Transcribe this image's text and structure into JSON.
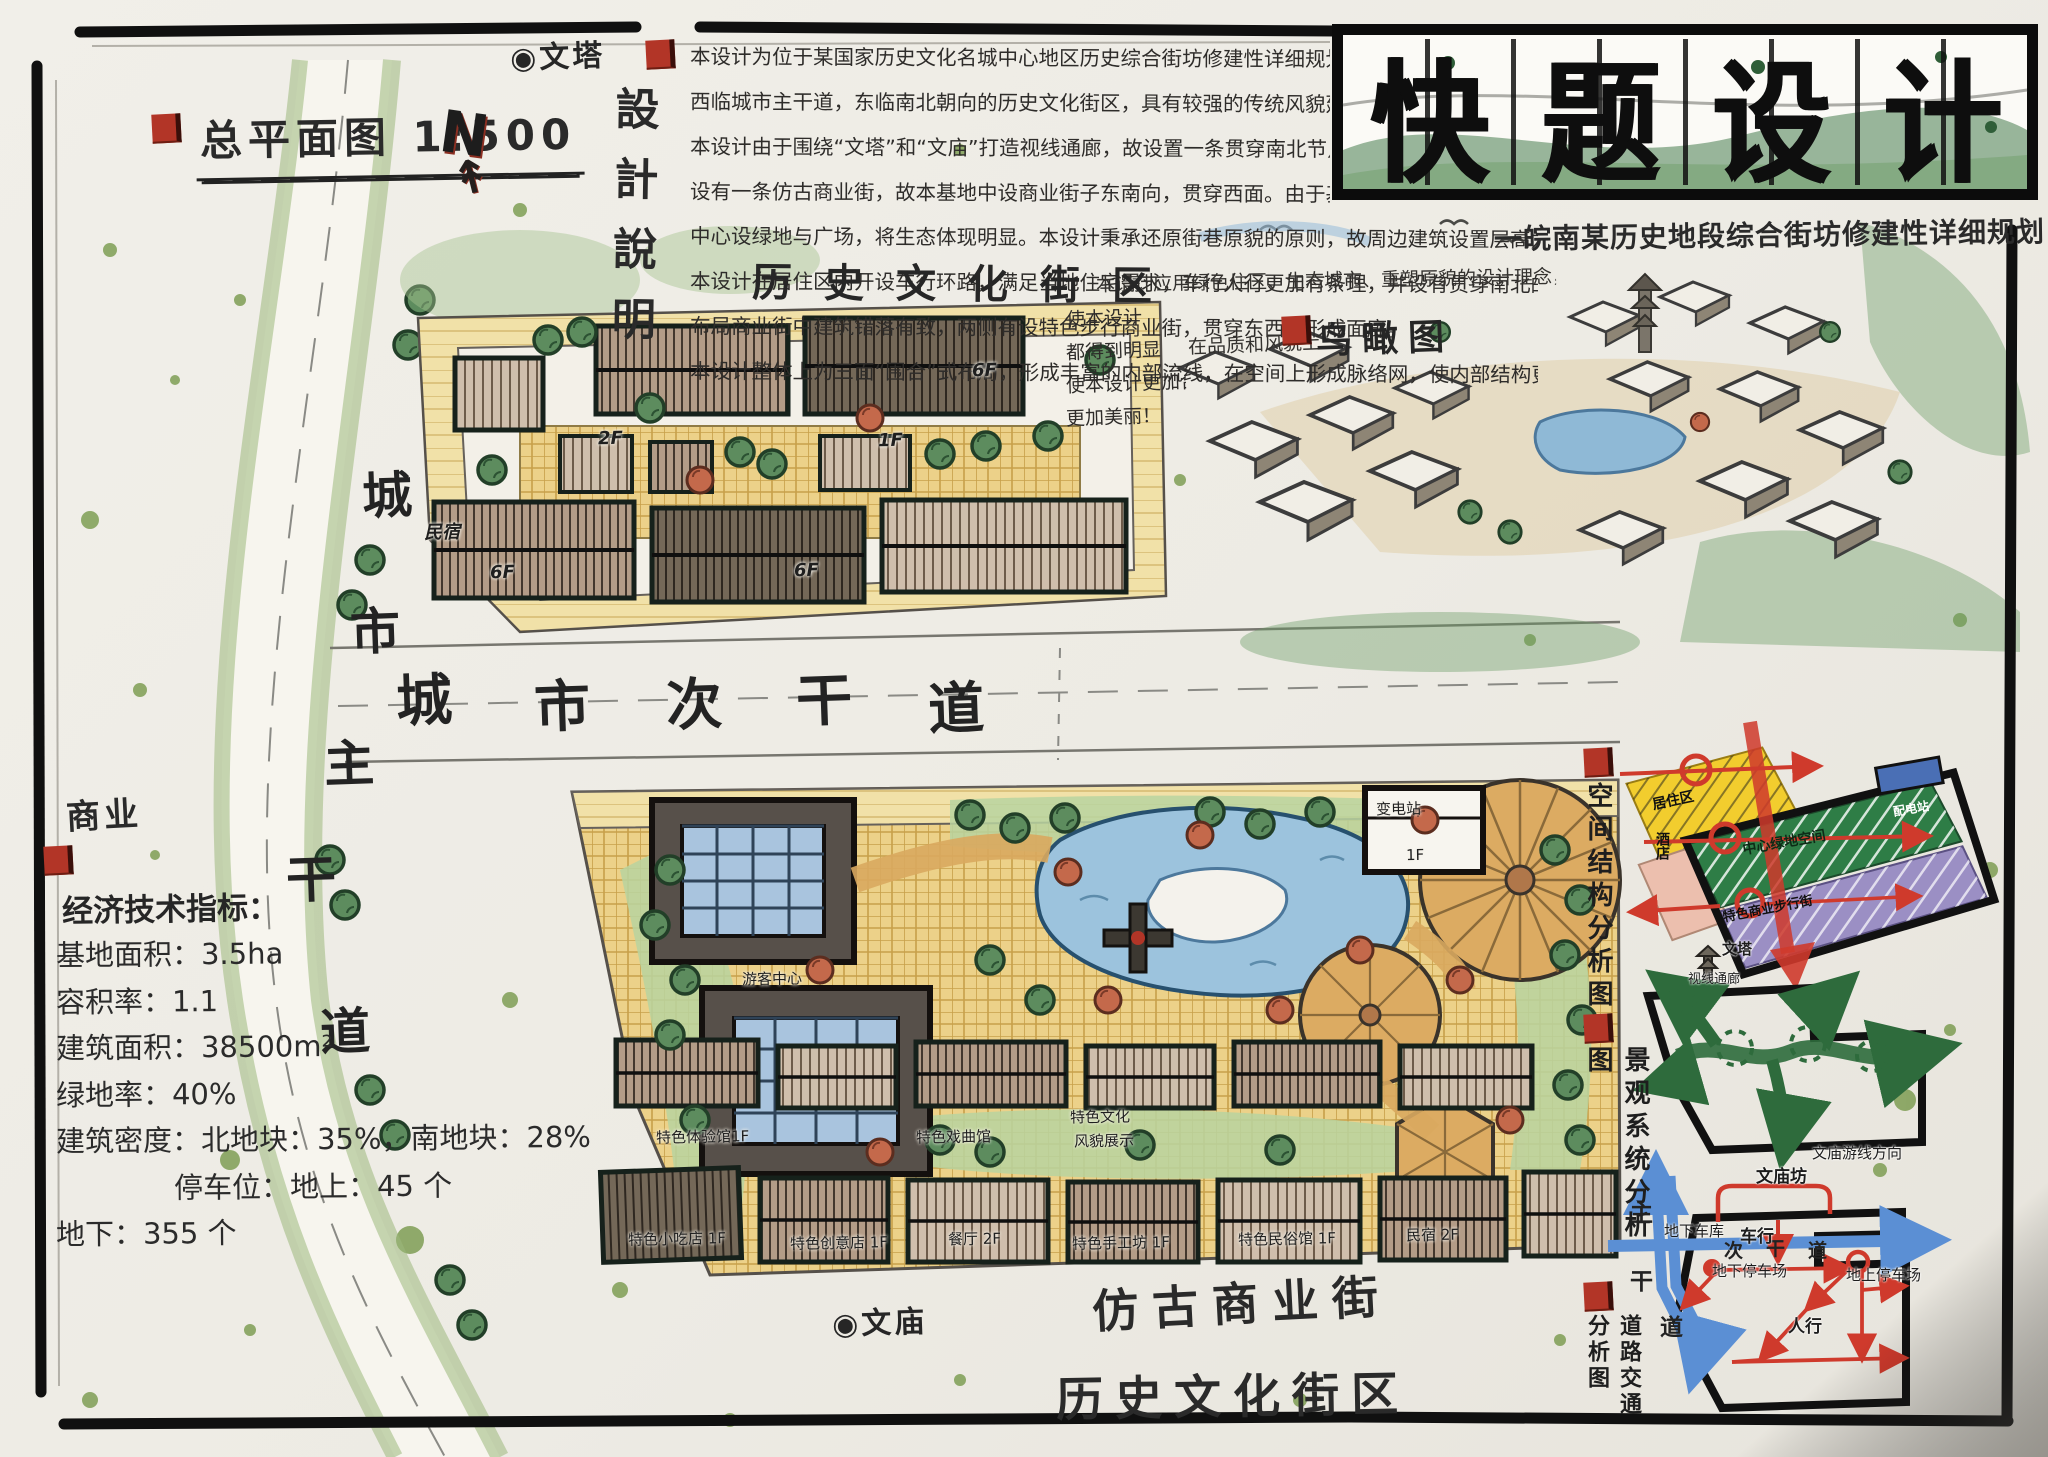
{
  "sheet": {
    "plan_title": "总平面图 1:500",
    "north_label": "N",
    "wenta_marker": "◉文塔",
    "wenmiao_marker": "◉文庙"
  },
  "design_notes": {
    "title": "設計說明",
    "lines_a": [
      "本设计为位于某国家历史文化名城中心地区历史综合街坊修建性详细规划，占地面积共3.5ha。",
      "西临城市主干道，东临南北朝向的历史文化街区，具有较强的传统风貌延续条件优势。",
      "本设计由于围绕“文塔”和“文庙”打造视线通廊，故设置一条贯穿南北节点的视线通廊。",
      "设有一条仿古商业街，故本基地中设商业街子东南向，贯穿西面。由于基地东南方向上侧为居住区，"
    ],
    "lines_b": [
      "中心设绿地与广场，将生态体现明显。本设计秉承还原街巷原貌的原则，故周边建筑设置层高为2-3层。",
      "本设计在居住区内开设车行环路，满足当地住宅需求，车行人行更加有条理，并设有贯穿南北的步行街，",
      "布局商业街中建筑错落有致，两侧有设特色步行商业街，贯穿东西，形成面廊。",
      "本设计整体上为三面“围合”式布局，形成丰富的内部流线，在空间上形成脉络网，使内部结构更加丰富、更有内涵。"
    ]
  },
  "banner": {
    "title_chars": [
      {
        "c": "快"
      },
      {
        "c": "题"
      },
      {
        "c": "设"
      },
      {
        "c": "计"
      }
    ],
    "subtitle": "一皖南某历史地段综合街坊修建性详细规划"
  },
  "aerial": {
    "label": "鸟瞰图",
    "note_top": "本设计应用绿色住区、生态城市、重塑原貌的设计理念，",
    "note_mid": "在品质和风貌上",
    "note_col": [
      "使本设计",
      "都得到明显",
      "使本设计更加合理",
      "更加美丽！"
    ]
  },
  "roads": {
    "commercial_label": "商业",
    "main_chars": [
      {
        "c": "城",
        "x": 362,
        "y": 456
      },
      {
        "c": "市",
        "x": 350,
        "y": 592
      },
      {
        "c": "主",
        "x": 324,
        "y": 724
      },
      {
        "c": "干",
        "x": 286,
        "y": 840
      },
      {
        "c": "道",
        "x": 320,
        "y": 992
      }
    ],
    "secondary_chars": [
      {
        "c": "城",
        "x": 396,
        "y": 656
      },
      {
        "c": "市",
        "x": 534,
        "y": 662
      },
      {
        "c": "次",
        "x": 666,
        "y": 660
      },
      {
        "c": "干",
        "x": 796,
        "y": 656
      },
      {
        "c": "道",
        "x": 928,
        "y": 664
      }
    ]
  },
  "indicators": {
    "title": "经济技术指标：",
    "lines": [
      "基地面积：3.5ha",
      "容积率：1.1",
      "建筑面积：38500m²",
      "绿地率：40%",
      "建筑密度：北地块：35%，南地块：28%",
      "停车位：地上：45 个",
      "地下：355 个"
    ]
  },
  "north_plan": {
    "district_label": "历史文化街区",
    "tags": [
      {
        "t": "6F",
        "x": 972,
        "y": 360
      },
      {
        "t": "6F",
        "x": 490,
        "y": 562
      },
      {
        "t": "6F",
        "x": 794,
        "y": 560
      },
      {
        "t": "2F",
        "x": 598,
        "y": 428
      },
      {
        "t": "1F",
        "x": 878,
        "y": 430
      },
      {
        "t": "民宿",
        "x": 424,
        "y": 518
      }
    ]
  },
  "south_plan": {
    "street_label": "仿古商业街",
    "district_label": "历史文化街区",
    "tags": [
      {
        "t": "变电站",
        "x": 1376,
        "y": 798
      },
      {
        "t": "1F",
        "x": 1406,
        "y": 846
      },
      {
        "t": "游客中心",
        "x": 742,
        "y": 968
      },
      {
        "t": "特色体验馆1F",
        "x": 656,
        "y": 1126
      },
      {
        "t": "特色戏曲馆",
        "x": 916,
        "y": 1126
      },
      {
        "t": "特色文化",
        "x": 1070,
        "y": 1106
      },
      {
        "t": "风貌展示",
        "x": 1074,
        "y": 1130
      },
      {
        "t": "特色小吃店 1F",
        "x": 628,
        "y": 1228
      },
      {
        "t": "特色创意店 1F",
        "x": 790,
        "y": 1232
      },
      {
        "t": "餐厅 2F",
        "x": 948,
        "y": 1228
      },
      {
        "t": "特色手工坊 1F",
        "x": 1072,
        "y": 1232
      },
      {
        "t": "特色民俗馆 1F",
        "x": 1238,
        "y": 1228
      },
      {
        "t": "民宿 2F",
        "x": 1406,
        "y": 1224
      }
    ]
  },
  "analysis": {
    "spatial": {
      "title": "空间结构分析图",
      "residential": "居住区",
      "hotel": "酒店",
      "green": "中心绿地空间",
      "substation": "配电站",
      "commercial": "特色商业步行街",
      "pagoda": "文塔",
      "sight": "视线通廊"
    },
    "landscape": {
      "title": "景观系统分析图",
      "dir_label": "文庙游线方向",
      "square_label": "文庙坊"
    },
    "traffic": {
      "title": "道路交通分析图",
      "garage": "地下车库",
      "vehicle": "车行",
      "underground": "地下停车场",
      "surface": "地上停车场",
      "pedestrian": "人行",
      "main_chars": [
        {
          "c": "主",
          "x": 1630,
          "y": 1194
        },
        {
          "c": "干",
          "x": 1630,
          "y": 1262
        },
        {
          "c": "道",
          "x": 1660,
          "y": 1308
        }
      ],
      "secondary_chars": [
        {
          "c": "次",
          "x": 1724,
          "y": 1236
        },
        {
          "c": "干",
          "x": 1766,
          "y": 1234
        },
        {
          "c": "道",
          "x": 1808,
          "y": 1236
        }
      ]
    }
  }
}
